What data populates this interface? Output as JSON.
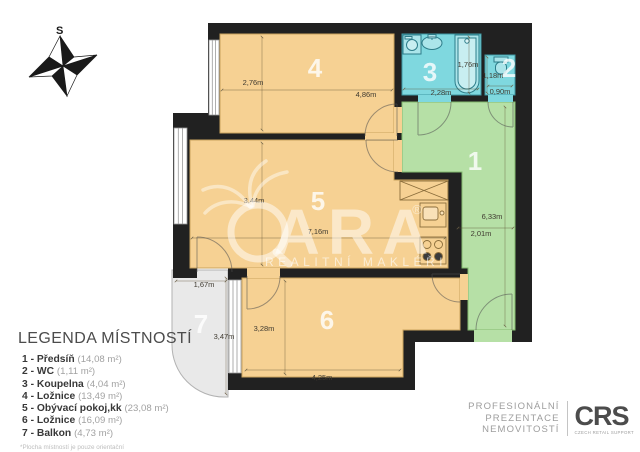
{
  "compass": {
    "north_label": "S"
  },
  "plan": {
    "rooms": [
      {
        "number": "1",
        "name": "Předsíň",
        "dim_a": "6,33m",
        "dim_b": "2,01m"
      },
      {
        "number": "2",
        "name": "WC",
        "dim_a": "1,18m",
        "dim_b": "0,90m"
      },
      {
        "number": "3",
        "name": "Koupelna",
        "dim_a": "1,76m",
        "dim_b": "2,28m"
      },
      {
        "number": "4",
        "name": "Ložnice",
        "dim_a": "2,76m",
        "dim_b": "4,86m"
      },
      {
        "number": "5",
        "name": "Obývací pokoj,kk",
        "dim_a": "3,44m",
        "dim_b": "7,16m"
      },
      {
        "number": "6",
        "name": "Ložnice",
        "dim_a": "3,28m",
        "dim_b": "4,25m"
      },
      {
        "number": "7",
        "name": "Balkon",
        "dim_a": "1,67m",
        "dim_b": "3,47m"
      }
    ],
    "colors": {
      "wall": "#212121",
      "room_orange": "#f6d193",
      "room_cyan": "#7fd8df",
      "room_green": "#b6e0a6",
      "balcony_gray": "#e9e9e9"
    }
  },
  "watermark": {
    "brand_tail": "ARA",
    "registered": "®",
    "subtitle": "REALITNÍ MAKLÉŘI"
  },
  "legend": {
    "title": "LEGENDA MÍSTNOSTÍ",
    "items": [
      {
        "label": "1 - Předsíň",
        "area": "(14,08 m²)"
      },
      {
        "label": "2 - WC",
        "area": "(1,11 m²)"
      },
      {
        "label": "3 - Koupelna",
        "area": "(4,04 m²)"
      },
      {
        "label": "4 - Ložnice",
        "area": "(13,49 m²)"
      },
      {
        "label": "5 - Obývací pokoj,kk",
        "area": "(23,08 m²)"
      },
      {
        "label": "6 - Ložnice",
        "area": "(16,09 m²)"
      },
      {
        "label": "7 - Balkon",
        "area": "(4,73 m²)"
      }
    ],
    "footnote": "*Plocha místností je pouze orientační"
  },
  "footer": {
    "tagline_1": "PROFESIONÁLNÍ",
    "tagline_2": "PREZENTACE",
    "tagline_3": "NEMOVITOSTÍ",
    "logo": "CRS",
    "logo_subtitle": "CZECH RETAIL SUPPORT"
  }
}
